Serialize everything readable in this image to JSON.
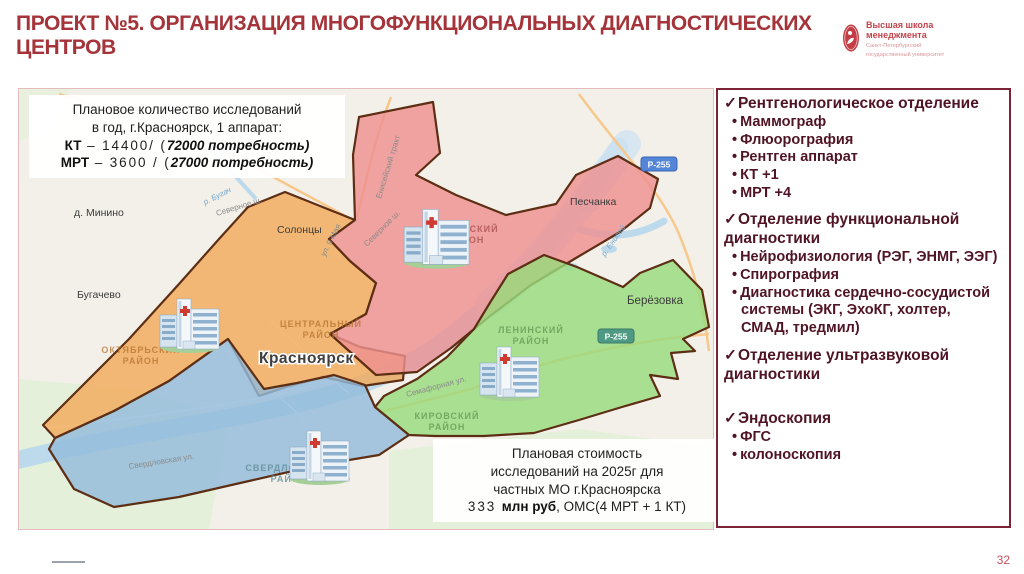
{
  "slide": {
    "title": "ПРОЕКТ №5. ОРГАНИЗАЦИЯ МНОГОФУНКЦИОНАЛЬНЫХ ДИАГНОСТИЧЕСКИХ ЦЕНТРОВ",
    "page_number": "32"
  },
  "logo": {
    "line1": "Высшая школа",
    "line2": "менеджмента",
    "sub1": "Санкт-Петербургский",
    "sub2": "государственный университет"
  },
  "map": {
    "overlay_top": {
      "line1": "Плановое количество исследований",
      "line2": "в год, г.Красноярск, 1 аппарат:",
      "kt": {
        "b": "КТ",
        "mid": " – 14400/ (",
        "tail": "72000 потребность)"
      },
      "mrt": {
        "b": "МРТ",
        "mid": " – 3600 / (",
        "tail": "27000 потребность)"
      }
    },
    "overlay_bottom": {
      "line1": "Плановая стоимость",
      "line2": "исследований на 2025г для",
      "line3": "частных МО г.Красноярска",
      "row4": {
        "pre": "333 ",
        "b": "млн руб",
        "post": ", ОМС(4 МРТ + 1 КТ)"
      }
    },
    "labels": {
      "towns": {
        "minino": "д. Минино",
        "solontsy": "Солонцы",
        "bugachevo": "Бугачево",
        "peschanka": "Песчанка",
        "berezovka": "Берёзовка",
        "krasnoyarsk": "Красноярск"
      },
      "streets": {
        "severnoe": "Северное ш.",
        "may9": "ул. 9 Мая",
        "eniseysky_trakt": "Енисейский тракт",
        "semafornaya": "Семафорная ул.",
        "sverdlovskaya": "Свердловская ул.",
        "bugach_river": "р. Бугач",
        "enisey_river": "р. Енисей"
      },
      "districts": {
        "sovetsky1": "СОВЕТСКИЙ",
        "sovetsky2": "РАЙОН",
        "centralny1": "ЦЕНТРАЛЬНЫЙ",
        "centralny2": "РАЙОН",
        "oktyabrsky1": "ОКТЯБРЬСКИЙ",
        "oktyabrsky2": "РАЙОН",
        "leninsky1": "ЛЕНИНСКИЙ",
        "leninsky2": "РАЙОН",
        "kirovsky1": "КИРОВСКИЙ",
        "kirovsky2": "РАЙОН",
        "sverdlovsky1": "СВЕРДЛОВСКИЙ",
        "sverdlovsky2": "РАЙОН"
      },
      "road_badge": "Р-255"
    },
    "zone_colors": {
      "orange": "#f2a95c",
      "red": "#ee9090",
      "blue": "#92bbda",
      "green": "#98da7d",
      "outline": "#5d2e14"
    }
  },
  "panel": {
    "check": "✓",
    "bullet": "•",
    "border_color": "#7b2435",
    "text_color": "#4f1425",
    "sections": [
      {
        "title": "Рентгенологическое отделение",
        "items": [
          "Маммограф",
          "Флюорография",
          "Рентген аппарат",
          "КТ +1",
          "МРТ +4"
        ]
      },
      {
        "title": "Отделение функциональной диагностики",
        "items": [
          "Нейрофизиология (РЭГ, ЭНМГ, ЭЭГ)",
          "Спирография",
          "Диагностика сердечно-сосудистой системы (ЭКГ, ЭхоКГ, холтер, СМАД, тредмил)"
        ]
      },
      {
        "title": "Отделение ультразвуковой диагностики",
        "items": []
      },
      {
        "title": "Эндоскопия",
        "items": [
          "ФГС",
          "колоноскопия"
        ]
      }
    ]
  }
}
